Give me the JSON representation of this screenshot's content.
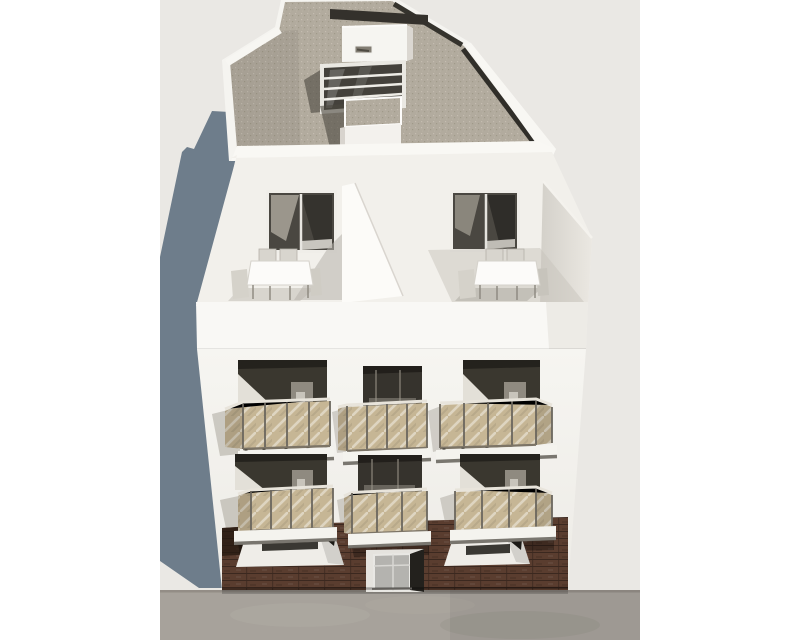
{
  "scene": {
    "type": "architectural-3d-render",
    "description": "Elevated aerial front view of a new-build four-storey apartment block: gravel flat roof with stair bulkhead and four-pane skylight, two roof terraces each with a white dining table and six chairs behind white parapets, two middle floors each with three balconies with tan tinted-glass railings over dark recessed openings, a dark brown brick ground floor with two recessed windows and a central glass entrance door, concrete sidewalk in front, building shadow cast to the lower left on a plain light grey backdrop with white side margins."
  },
  "building": {
    "storeys": 4,
    "roof": {
      "finish": "grey gravel",
      "features": [
        "stair-bulkhead",
        "roof-hatch",
        "skylight-four-panes",
        "service-box",
        "white-parapets"
      ]
    },
    "top_floor": {
      "terraces": 2,
      "tables": 2,
      "chairs_visible_per_table": 4,
      "sliding_glass_doors": 2,
      "divider_wall": true
    },
    "middle_floors": {
      "count": 2,
      "balconies_per_floor": 3,
      "balconies_total": 6,
      "railing": "tan tinted glass with metal posts",
      "dark_openings_per_floor": 3
    },
    "ground_floor": {
      "cladding": "dark brown brick",
      "recessed_windows": 2,
      "entrance_doors": 1
    }
  },
  "environment": {
    "backdrop": "plain light grey",
    "sidewalk": "grey concrete pavement strip",
    "shadow": "building shadow cast to lower-left",
    "margins": "white vertical bands left and right"
  },
  "palette": {
    "margin": "#ffffff",
    "backdrop": "#eae8e4",
    "shadow": "#6e7d8b",
    "sidewalk": "#a7a29b",
    "sidewalk_edge": "#8a857d",
    "roof_parapet": "#f5f4f0",
    "gravel": "#b2ab9e",
    "gravel_edge_dark": "#34312c",
    "bulkhead": "#f6f5f1",
    "skylight_glass": "#44413b",
    "skylight_frame": "#eae8e2",
    "terrace_wall": "#f2f0eb",
    "terrace_door_glass": "#4a4741",
    "divider_wall": "#fcfbf8",
    "right_wall_dark": "#d3d0c9",
    "right_wall_light": "#ebe8e2",
    "table_top": "#fcfbf9",
    "chair": "#d8d5ce",
    "parapet_band": "#f9f8f5",
    "facade_top": "#f6f5f1",
    "facade_bottom": "#edebe6",
    "opening_dark": "#3a372f",
    "opening_ceiling": "#24221d",
    "reveal_light": "#e3e0d8",
    "balcony_glass": "#c6b695",
    "balcony_post": "#6b675e",
    "balcony_rail": "#e8e4db",
    "slab": "#f4f3ee",
    "slab_shadow": "#514d45",
    "brick": "#5a3d2f",
    "brick_line": "#3f2a1e",
    "entry_glass": "#b4b3af",
    "entry_jamb_dark": "#23211d",
    "window_recess": "#efede8",
    "window_dark": "#3a3833"
  }
}
